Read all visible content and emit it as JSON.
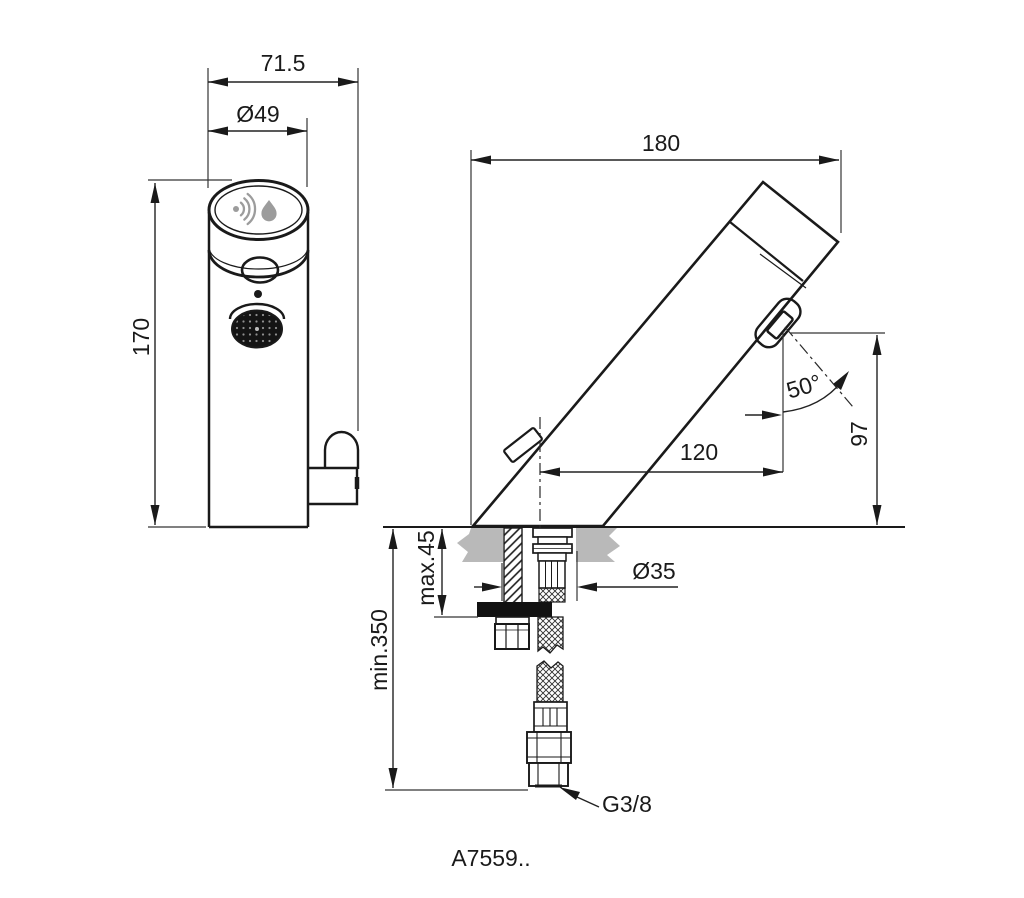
{
  "product_code": "A7559..",
  "front_view": {
    "overall_width": "71.5",
    "body_diameter": "Ø49",
    "overall_height": "170"
  },
  "side_view": {
    "overall_depth": "180",
    "spout_angle": "50°",
    "spout_reach": "120",
    "spout_height": "97",
    "deck_thickness_max": "max.45",
    "deck_hole_diameter": "Ø35",
    "hose_clearance_min": "min.350",
    "supply_connection": "G3/8"
  },
  "colors": {
    "line": "#1a1a1a",
    "deck_gray": "#b9b9b9",
    "icon_gray": "#9c9c9c",
    "background": "#ffffff"
  }
}
